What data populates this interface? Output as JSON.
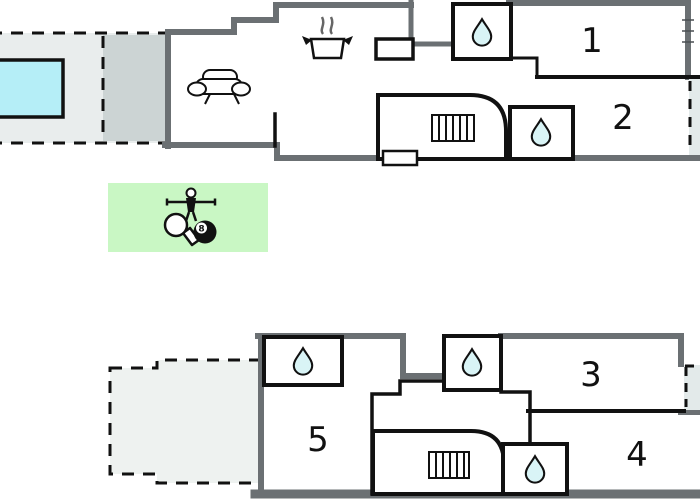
{
  "plan": {
    "type": "holiday-home floor plan, two levels",
    "rooms": [
      {
        "id": "room-1",
        "label": "1"
      },
      {
        "id": "room-2",
        "label": "2"
      },
      {
        "id": "room-3",
        "label": "3"
      },
      {
        "id": "room-4",
        "label": "4"
      },
      {
        "id": "room-5",
        "label": "5"
      }
    ],
    "game_room": {
      "ball_label": "8"
    },
    "features": [
      "swimming-pool",
      "pool-terrace",
      "covered-patio",
      "game-room",
      "bathroom-upper-1",
      "bathroom-upper-2",
      "bathroom-lower-1",
      "bathroom-lower-2",
      "bathroom-lower-3",
      "stairs-upper",
      "stairs-lower",
      "balcony-upper",
      "balcony-lower",
      "terrace-lower",
      "sofa",
      "kitchen"
    ],
    "icons": [
      "water-drop-icon",
      "sofa-icon",
      "cooking-pot-icon",
      "stairs-icon",
      "foosball-player-icon",
      "table-tennis-paddle-icon",
      "billiard-8-ball-icon"
    ],
    "colors": {
      "wall_gray": "#6b7073",
      "line_black": "#111111",
      "pool_cyan": "#b5eef7",
      "drop_fill": "#d9f4f6",
      "terrace_fill": "#e9eded",
      "patio_fill": "#ccd4d4",
      "lower_terrace_fill": "#eef2f0",
      "balcony_fill": "#e3eaea",
      "game_room_green": "#c9f7c4"
    }
  }
}
